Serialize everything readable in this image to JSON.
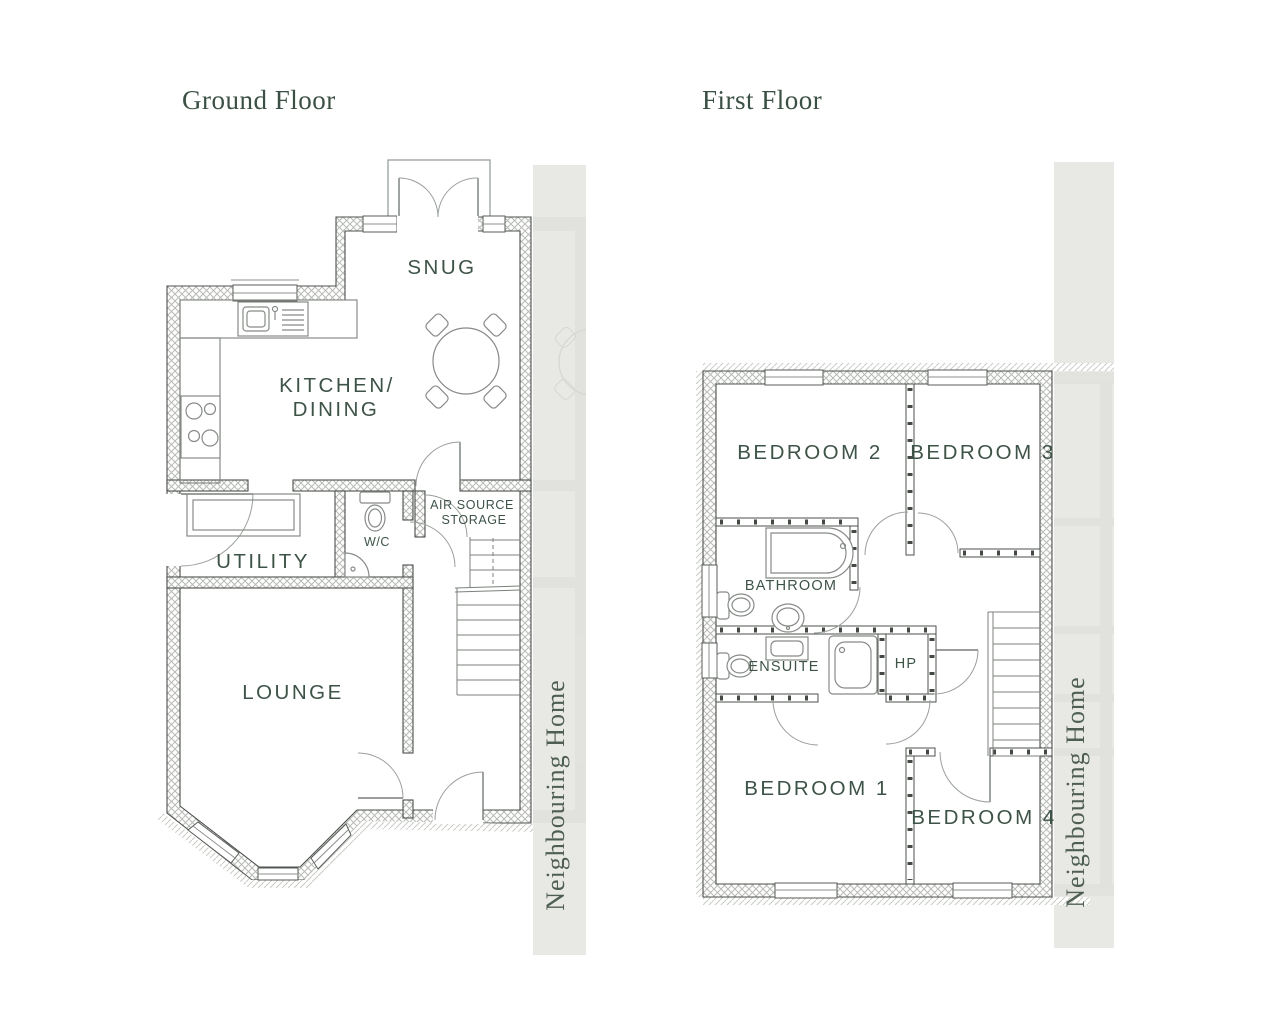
{
  "colors": {
    "page_bg": "#ffffff",
    "title_green": "#3b5044",
    "label_green": "#3e5347",
    "neighbour_text": "#4f5e53",
    "wall_line": "#4c504c",
    "fixture_line": "#878b87",
    "strip_bg": "#e8e9e5",
    "strip_faint": "#dcded8"
  },
  "ground_floor": {
    "title": "Ground Floor",
    "rooms": {
      "snug": "SNUG",
      "kitchen_line1": "KITCHEN/",
      "kitchen_line2": "DINING",
      "utility": "UTILITY",
      "wc": "W/C",
      "air_source_line1": "AIR SOURCE",
      "air_source_line2": "STORAGE",
      "lounge": "LOUNGE"
    },
    "neighbour_label": "Neighbouring Home"
  },
  "first_floor": {
    "title": "First Floor",
    "rooms": {
      "bedroom2": "BEDROOM 2",
      "bedroom3": "BEDROOM 3",
      "bathroom": "BATHROOM",
      "ensuite": "ENSUITE",
      "hp": "HP",
      "bedroom1": "BEDROOM 1",
      "bedroom4": "BEDROOM 4"
    },
    "neighbour_label": "Neighbouring Home"
  }
}
